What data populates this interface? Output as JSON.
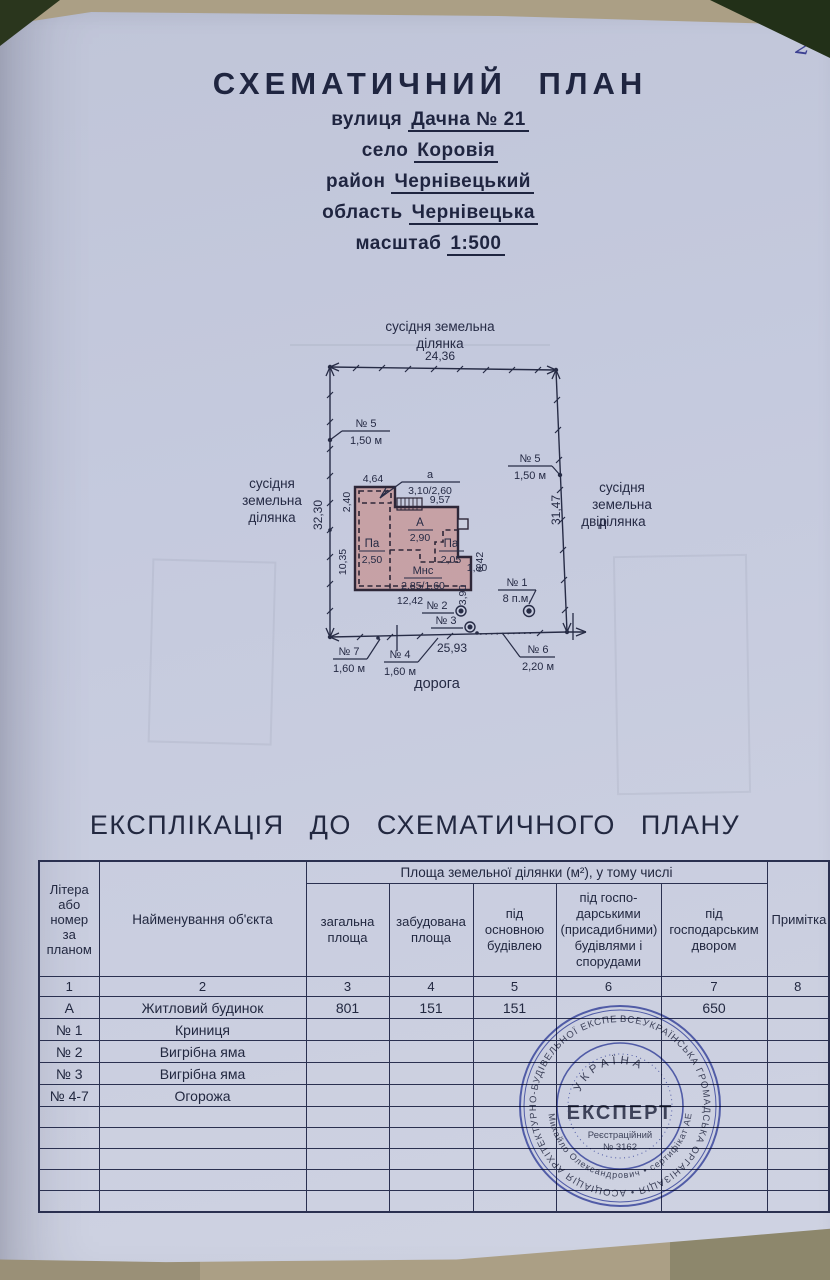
{
  "page": {
    "number": "2"
  },
  "title": {
    "heading": "СХЕМАТИЧНИЙ  ПЛАН",
    "lines": [
      {
        "label": "вулиця",
        "value": "Дачна № 21"
      },
      {
        "label": "село",
        "value": "Коровія"
      },
      {
        "label": "район",
        "value": "Чернівецький"
      },
      {
        "label": "область",
        "value": "Чернівецька"
      },
      {
        "label": "масштаб",
        "value": "1:500"
      }
    ]
  },
  "plan": {
    "neighbor_top_line1": "сусідня земельна",
    "neighbor_top_line2": "ділянка",
    "neighbor_side_line1": "сусідня",
    "neighbor_side_line2": "земельна",
    "neighbor_side_line3": "ділянка",
    "dim_top": "24,36",
    "dim_left": "32,30",
    "dim_right": "31,47",
    "dim_bottom": "25,93",
    "dim_building_width": "12,42",
    "dim_main_width": "9,57",
    "dim_annex_width": "4,64",
    "dim_annex_height": "2,40",
    "dim_left_wall": "10,35",
    "dim_ext_width": "1,80",
    "dim_ext_height": "3,90",
    "dim_right_wall": "6,42",
    "annex_label": "а",
    "annex_value": "3,10/2,60",
    "room_a_label": "А",
    "room_a_value": "2,90",
    "room_pa_left_label": "Па",
    "room_pa_left_value": "2,50",
    "room_pa_right_label": "Па",
    "room_pa_right_value": "2,05",
    "room_mns_label": "Мнс",
    "room_mns_value": "2,85/1,60",
    "yard_label": "двір",
    "road_label": "дорога",
    "mark1_no": "№ 1",
    "mark1_len": "8 п.м.",
    "mark2_no": "№ 2",
    "mark3_no": "№ 3",
    "mark4_no": "№ 4",
    "mark4_len": "1,60 м",
    "mark5_no": "№ 5",
    "mark5_len": "1,50 м",
    "mark6_no": "№ 6",
    "mark6_len": "2,20 м",
    "mark7_no": "№ 7",
    "mark7_len": "1,60 м"
  },
  "explication": {
    "title": "ЕКСПЛІКАЦІЯ  ДО  СХЕМАТИЧНОГО  ПЛАНУ"
  },
  "table": {
    "header": {
      "col1": "Літера або номер за планом",
      "col2": "Найменування об'єкта",
      "span": "Площа земельної ділянки (м²), у тому числі",
      "col3": "загальна площа",
      "col4": "забудована площа",
      "col5": "під основною будівлею",
      "col6": "під госпо­дарськими (присадибними) будівлями і спорудами",
      "col7": "під господарським двором",
      "col8": "Примітка"
    },
    "colnums": {
      "c1": "1",
      "c2": "2",
      "c3": "3",
      "c4": "4",
      "c5": "5",
      "c6": "6",
      "c7": "7",
      "c8": "8"
    },
    "rows": [
      {
        "c1": "А",
        "c2": "Житловий будинок",
        "c3": "801",
        "c4": "151",
        "c5": "151",
        "c6": "",
        "c7": "650",
        "c8": ""
      },
      {
        "c1": "№ 1",
        "c2": "Криниця",
        "c3": "",
        "c4": "",
        "c5": "",
        "c6": "",
        "c7": "",
        "c8": ""
      },
      {
        "c1": "№ 2",
        "c2": "Вигрібна яма",
        "c3": "",
        "c4": "",
        "c5": "",
        "c6": "",
        "c7": "",
        "c8": ""
      },
      {
        "c1": "№ 3",
        "c2": "Вигрібна яма",
        "c3": "",
        "c4": "",
        "c5": "",
        "c6": "",
        "c7": "",
        "c8": ""
      },
      {
        "c1": "№ 4-7",
        "c2": "Огорожа",
        "c3": "",
        "c4": "",
        "c5": "",
        "c6": "",
        "c7": "",
        "c8": ""
      }
    ]
  },
  "stamp": {
    "ring_text": "ВСЕУКРАЇНСЬКА ГРОМАДСЬКА ОРГАНІЗАЦІЯ • АСОЦІАЦІЯ АРХІТЕКТУРНО-БУДІВЕЛЬНОЇ ЕКСПЕРТИЗИ • ІНВЕНТАРИЗАЦІЯ",
    "ring2_text": "Михайло Олександрович • сертифікат АЕ №",
    "country": "УКРАЇНА",
    "name": "ЕКСПЕРТ",
    "reg_line1": "Реєстраційний",
    "reg_line2": "№ 3162"
  }
}
